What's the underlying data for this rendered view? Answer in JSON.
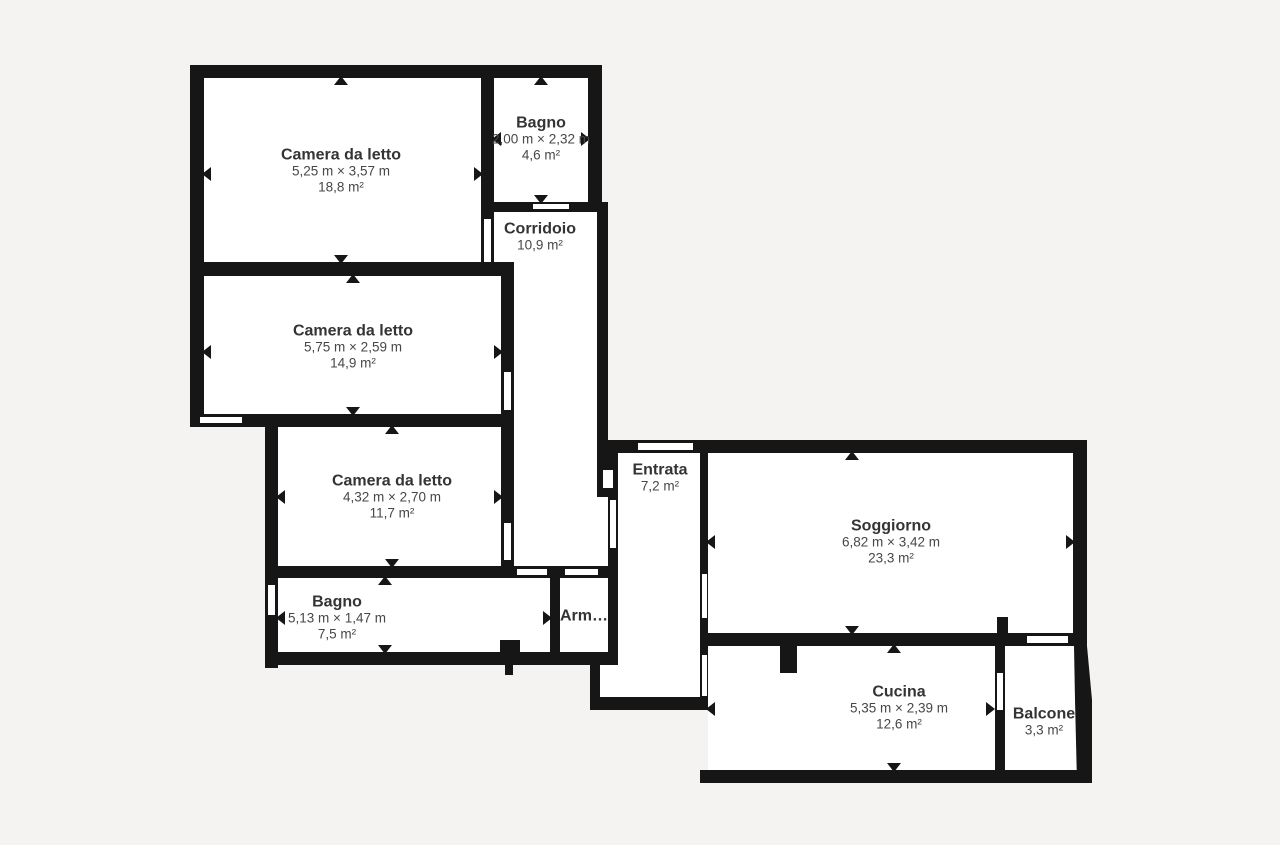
{
  "palette": {
    "background": "#f4f3f1",
    "walls": "#161616",
    "room_fill": "#ffffff",
    "room_name_text": "#343434",
    "secondary_text": "#474747"
  },
  "rooms": {
    "camera1": {
      "name": "Camera da letto",
      "dims": "5,25 m × 3,57 m",
      "area": "18,8 m²"
    },
    "bagno_top": {
      "name": "Bagno",
      "dims": "2,00 m × 2,32 m",
      "area": "4,6 m²"
    },
    "corridoio": {
      "name": "Corridoio",
      "area": "10,9 m²"
    },
    "camera2": {
      "name": "Camera da letto",
      "dims": "5,75 m × 2,59 m",
      "area": "14,9 m²"
    },
    "camera3": {
      "name": "Camera da letto",
      "dims": "4,32 m × 2,70 m",
      "area": "11,7 m²"
    },
    "bagno_bottom": {
      "name": "Bagno",
      "dims": "5,13 m × 1,47 m",
      "area": "7,5 m²"
    },
    "armadio": {
      "name": "Arm…"
    },
    "entrata": {
      "name": "Entrata",
      "area": "7,2 m²"
    },
    "soggiorno": {
      "name": "Soggiorno",
      "dims": "6,82 m × 3,42 m",
      "area": "23,3 m²"
    },
    "cucina": {
      "name": "Cucina",
      "dims": "5,35 m × 2,39 m",
      "area": "12,6 m²"
    },
    "balcone": {
      "name": "Balcone",
      "area": "3,3 m²"
    }
  }
}
